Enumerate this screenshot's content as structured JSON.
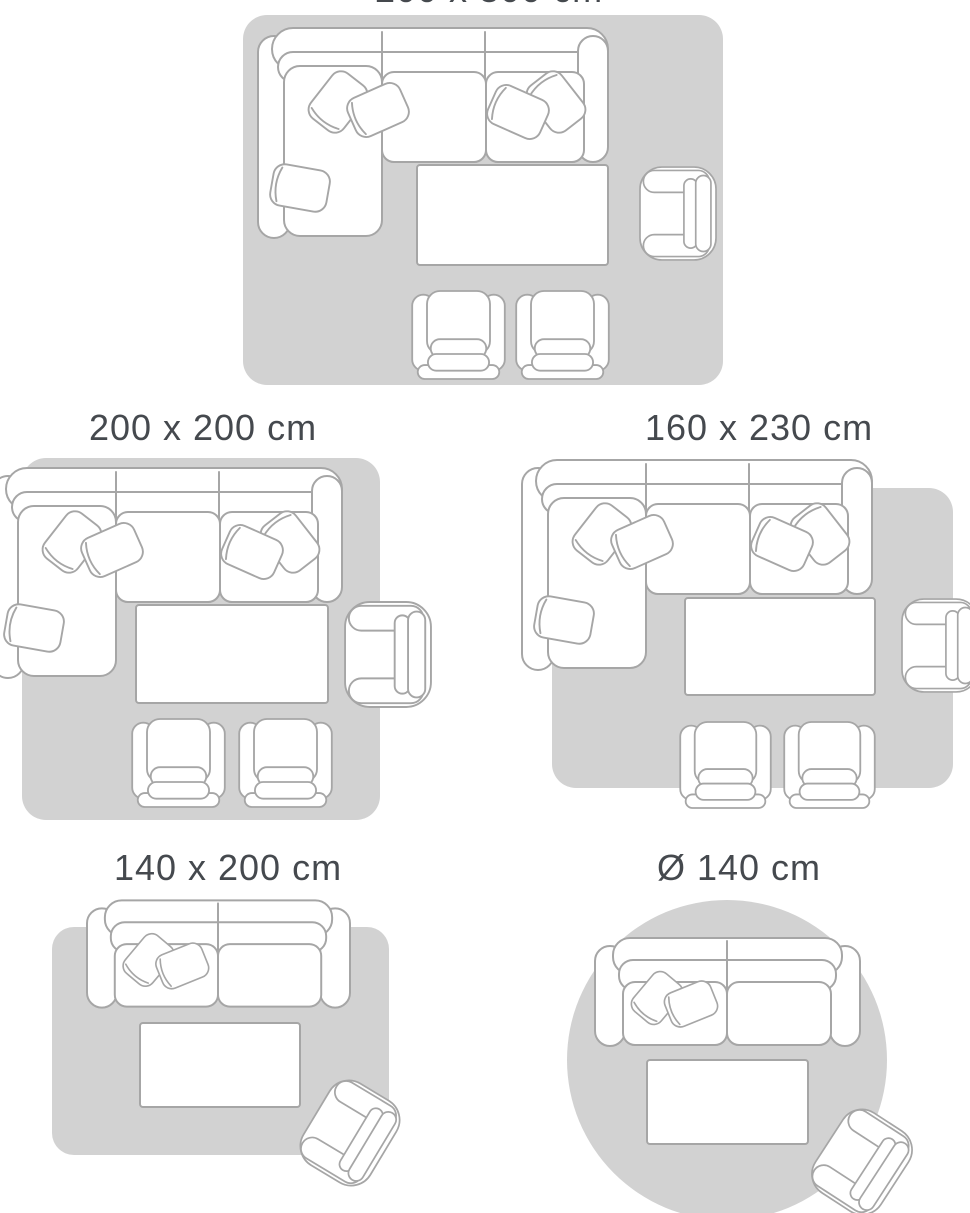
{
  "palette": {
    "background": "#ffffff",
    "rug_fill": "#d2d2d2",
    "furniture_fill": "#ffffff",
    "furniture_outline": "#a6a6a6",
    "label_color": "#45494e"
  },
  "diagrams": [
    {
      "label": "200 x 300 cm",
      "rug_shape": "rectangle",
      "furniture": [
        "corner-sofa",
        "coffee-table",
        "armchair",
        "footstool",
        "footstool"
      ],
      "note": "label clipped at top edge of viewport"
    },
    {
      "label": "200 x 200 cm",
      "rug_shape": "rectangle",
      "furniture": [
        "corner-sofa",
        "coffee-table",
        "armchair",
        "footstool",
        "footstool"
      ]
    },
    {
      "label": "160 x 230 cm",
      "rug_shape": "rectangle",
      "furniture": [
        "corner-sofa",
        "coffee-table",
        "armchair",
        "footstool",
        "footstool"
      ]
    },
    {
      "label": "140 x 200 cm",
      "rug_shape": "rectangle",
      "furniture": [
        "two-seat-sofa",
        "coffee-table",
        "armchair"
      ]
    },
    {
      "label": "Ø 140 cm",
      "rug_shape": "circle",
      "furniture": [
        "two-seat-sofa",
        "coffee-table",
        "armchair"
      ]
    }
  ]
}
